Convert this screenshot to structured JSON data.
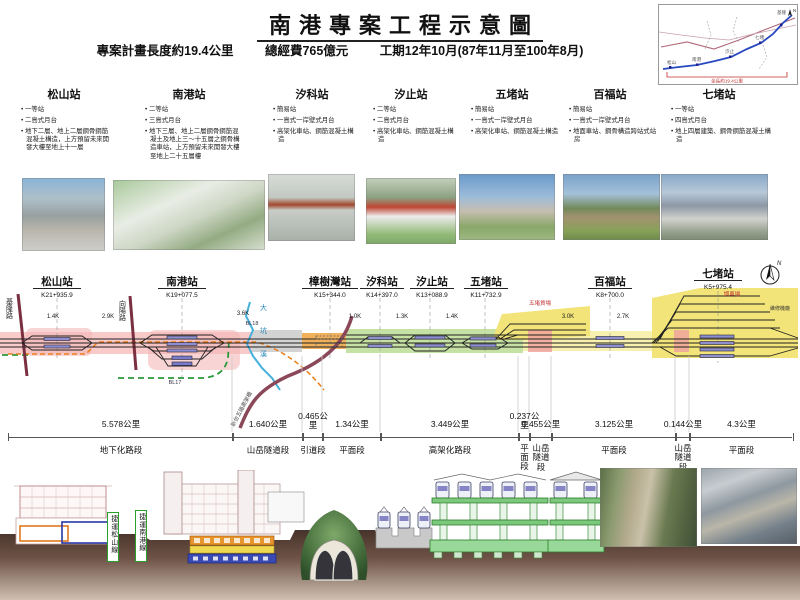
{
  "header": {
    "title": "南港專案工程示意圖",
    "stat_length": "專案計畫長度約19.4公里",
    "stat_cost": "總經費765億元",
    "stat_duration": "工期12年10月(87年11月至100年8月)"
  },
  "inset": {
    "length_label": "全長約19.4公里",
    "north": "N",
    "labels": [
      "松山",
      "南港",
      "汐止",
      "七堵",
      "基隆"
    ]
  },
  "station_info": [
    {
      "name": "松山站",
      "grade": "一等站",
      "platform": "二島式月台",
      "structure": "地下二層、地上二層鋼骨鋼筋混凝土構造，上方預留未來開發大樓至地上十一層"
    },
    {
      "name": "南港站",
      "grade": "二等站",
      "platform": "三島式月台",
      "structure": "地下三層、地上二層鋼骨鋼筋混凝土及地上三～十五層之鋼骨構造車站，上方預留未來開發大樓至地上二十五層樓"
    },
    {
      "name": "汐科站",
      "grade": "簡易站",
      "platform": "一島式一岸壁式月台",
      "structure": "高架化車站、鋼筋混凝土構造"
    },
    {
      "name": "汐止站",
      "grade": "二等站",
      "platform": "二島式月台",
      "structure": "高架化車站、鋼筋混凝土構造"
    },
    {
      "name": "五堵站",
      "grade": "簡易站",
      "platform": "一島式一岸壁式月台",
      "structure": "高架化車站、鋼筋混凝土構造"
    },
    {
      "name": "百福站",
      "grade": "簡易站",
      "platform": "一島式一岸壁式月台",
      "structure": "地面車站、鋼骨構造跨站式站房"
    },
    {
      "name": "七堵站",
      "grade": "一等站",
      "platform": "四島式月台",
      "structure": "地上四層建築、鋼骨鋼筋混凝土構造"
    }
  ],
  "diagram": {
    "stations": [
      {
        "name": "松山站",
        "chainage": "K21+935.9"
      },
      {
        "name": "南港站",
        "chainage": "K19+077.5"
      },
      {
        "name": "樟樹灣站",
        "chainage": "K15+344.0"
      },
      {
        "name": "汐科站",
        "chainage": "K14+397.0"
      },
      {
        "name": "汐止站",
        "chainage": "K13+088.9"
      },
      {
        "name": "五堵站",
        "chainage": "K11+732.9"
      },
      {
        "name": "百福站",
        "chainage": "K8+700.0"
      },
      {
        "name": "七堵站",
        "chainage": "K5+975.4"
      }
    ],
    "distances": [
      "1.4K",
      "2.9K",
      "3.6K",
      "1.0K",
      "1.3K",
      "1.4K",
      "3.0K",
      "2.7K"
    ],
    "road_keelung": "基隆路",
    "road_xiangyang": "向陽路",
    "river": "大坑溪",
    "elevated_road": "新台五路高架橋",
    "mrt_bl18": "BL18",
    "mrt_bl17": "BL17",
    "yard_wudu": "五堵貨場",
    "yard_qidu": "調車場",
    "depot": "維修機廠",
    "compass": "N"
  },
  "ruler": [
    {
      "dist": "5.578公里",
      "name": "地下化路段"
    },
    {
      "dist": "1.640公里",
      "name": "山岳隧道段"
    },
    {
      "dist": "0.465公里",
      "name": "引道段"
    },
    {
      "dist": "1.34公里",
      "name": "平面段"
    },
    {
      "dist": "3.449公里",
      "name": "高架化路段"
    },
    {
      "dist": "0.237公里",
      "name": "平面段"
    },
    {
      "dist": "0.455公里",
      "name": "山岳隧道段"
    },
    {
      "dist": "3.125公里",
      "name": "平面段"
    },
    {
      "dist": "0.144公里",
      "name": "山岳隧道段"
    },
    {
      "dist": "4.3公里",
      "name": "平面段"
    }
  ],
  "bottom": {
    "mrt_songshan": "捷運松山線",
    "mrt_nangang": "捷運南港線"
  },
  "colors": {
    "underground_pink": "#f5b8b8",
    "tunnel_gray": "#cbcbcb",
    "at_grade_orange": "#f0a848",
    "elevated_green": "#bfdf9a",
    "yard_yellow": "#f2e478",
    "river_blue": "#45b0dc",
    "mrt_dash_green": "#2a9a3a",
    "road_maroon": "#8a4858"
  }
}
